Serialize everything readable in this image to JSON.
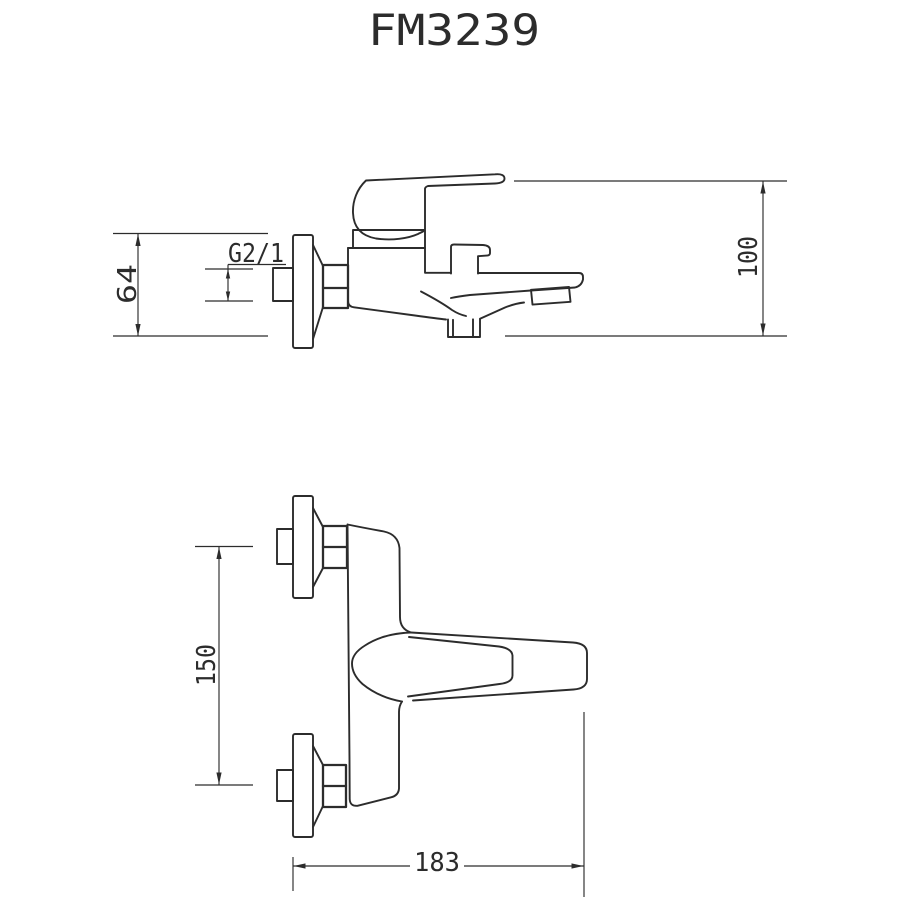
{
  "title": "FM3239",
  "colors": {
    "background": "#ffffff",
    "line": "#2c2c2c"
  },
  "views": {
    "side": {
      "thread_label": "G2/1",
      "dim_flange_to_outlet": "64",
      "dim_top_to_outlet": "100"
    },
    "front": {
      "dim_center_spacing": "150",
      "dim_overall_length": "183"
    }
  }
}
